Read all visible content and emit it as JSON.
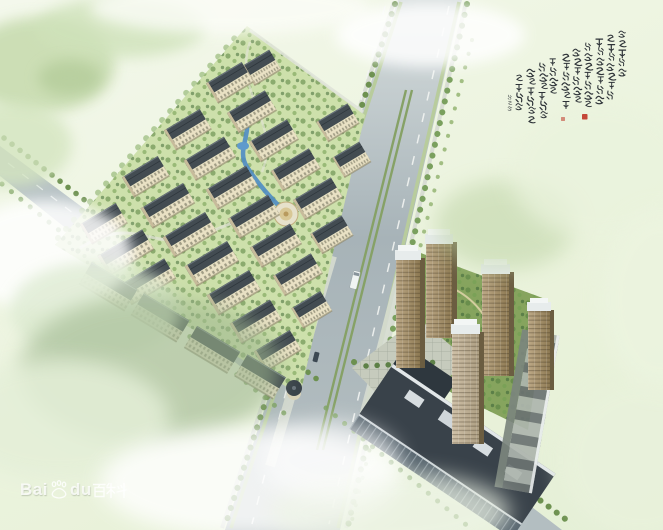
{
  "scene": {
    "type": "aerial architectural rendering",
    "subject": "bird's-eye masterplan rendering of a residential community: low-rise apartment district upper-left, high-rise towers with commercial podium lower-right, two tree-lined roads crossing at an intersection, misty pale-green surroundings",
    "watermark": {
      "latin_a": "Bai",
      "latin_b": "du",
      "cjk": "百科",
      "full_text": "Baidu百科"
    },
    "inscription": {
      "style": "vertical Chinese running-script calligraphy poem (illegible cursive)",
      "columns": 10,
      "has_signature_column": true,
      "seals": 2,
      "ink_color": "#2e3338",
      "seal_color": "#c03426"
    },
    "elements": [
      "main-boulevard",
      "west-cross-road",
      "southeast-road",
      "residential-site",
      "apartment-building",
      "perimeter-retail-block",
      "corner-tower",
      "water-stream",
      "central-plaza",
      "highrise-tower",
      "commercial-podium",
      "landscaped-garden",
      "paved-plaza",
      "white-bus",
      "dark-car",
      "street-tree-row"
    ],
    "palette": {
      "mist": "#eef5e2",
      "road": "#a9b5ba",
      "slab_roof": "#434c52",
      "slab_facade": "#e9e1c4",
      "tower_tan": "#a78f63",
      "tree_green": "#5f8746",
      "water_blue": "#4f8cc4",
      "seal_red": "#c03426",
      "watermark_white": "#ffffff"
    }
  }
}
